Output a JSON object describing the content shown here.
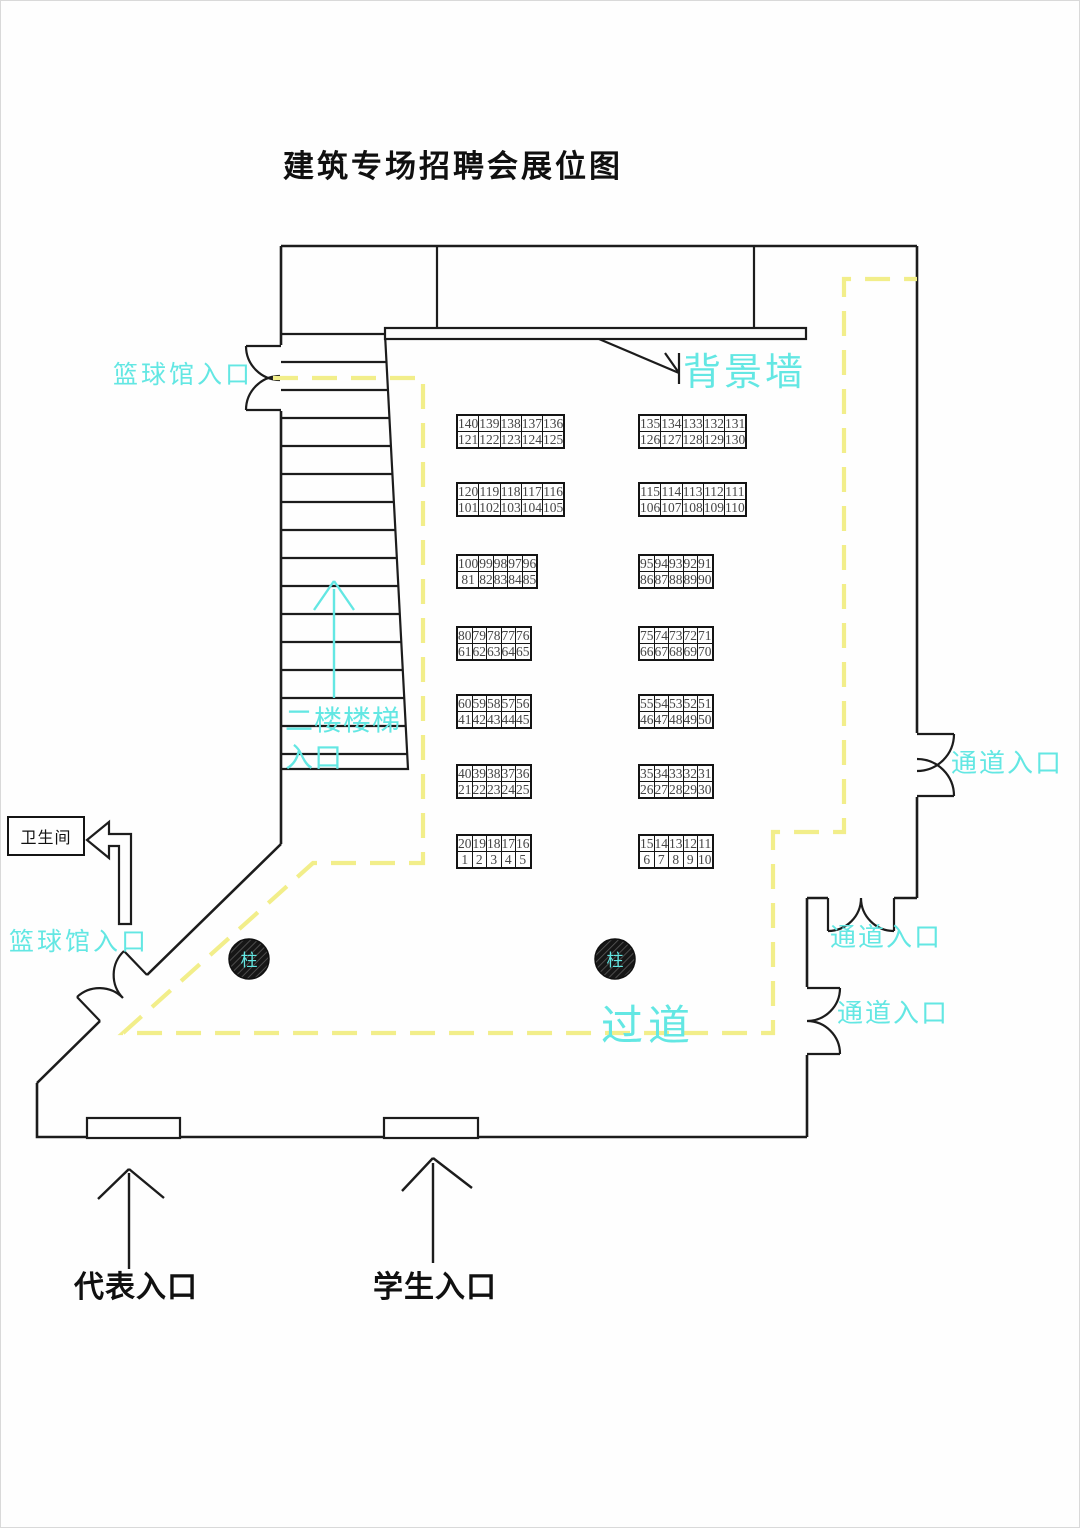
{
  "page": {
    "title": "建筑专场招聘会展位图"
  },
  "colors": {
    "accent_cyan": "#63e7e3",
    "path_yellow": "#f2ee8a",
    "line_ink": "#1c1c1c",
    "booth_number_ink": "#454545"
  },
  "labels": {
    "background_wall": "背景墙",
    "basketball_entrance_top": "篮球馆入口",
    "basketball_entrance_bottom": "篮球馆入口",
    "stairs_line1": "二楼楼梯",
    "stairs_line2": "入口",
    "passage_entrance_1": "通道入口",
    "passage_entrance_2": "通道入口",
    "passage_entrance_3": "通道入口",
    "aisle": "过道",
    "restroom": "卫生间",
    "representative_entrance": "代表入口",
    "student_entrance": "学生入口",
    "column": "柱"
  },
  "booths": {
    "bands": [
      {
        "left": {
          "top": [
            140,
            139,
            138,
            137,
            136
          ],
          "bottom": [
            121,
            122,
            123,
            124,
            125
          ]
        },
        "right": {
          "top": [
            135,
            134,
            133,
            132,
            131
          ],
          "bottom": [
            126,
            127,
            128,
            129,
            130
          ]
        }
      },
      {
        "left": {
          "top": [
            120,
            119,
            118,
            117,
            116
          ],
          "bottom": [
            101,
            102,
            103,
            104,
            105
          ]
        },
        "right": {
          "top": [
            115,
            114,
            113,
            112,
            111
          ],
          "bottom": [
            106,
            107,
            108,
            109,
            110
          ]
        }
      },
      {
        "left": {
          "top": [
            100,
            99,
            98,
            97,
            96
          ],
          "bottom": [
            81,
            82,
            83,
            84,
            85
          ]
        },
        "right": {
          "top": [
            95,
            94,
            93,
            92,
            91
          ],
          "bottom": [
            86,
            87,
            88,
            89,
            90
          ]
        }
      },
      {
        "left": {
          "top": [
            80,
            79,
            78,
            77,
            76
          ],
          "bottom": [
            61,
            62,
            63,
            64,
            65
          ]
        },
        "right": {
          "top": [
            75,
            74,
            73,
            72,
            71
          ],
          "bottom": [
            66,
            67,
            68,
            69,
            70
          ]
        }
      },
      {
        "left": {
          "top": [
            60,
            59,
            58,
            57,
            56
          ],
          "bottom": [
            41,
            42,
            43,
            44,
            45
          ]
        },
        "right": {
          "top": [
            55,
            54,
            53,
            52,
            51
          ],
          "bottom": [
            46,
            47,
            48,
            49,
            50
          ]
        }
      },
      {
        "left": {
          "top": [
            40,
            39,
            38,
            37,
            36
          ],
          "bottom": [
            21,
            22,
            23,
            24,
            25
          ]
        },
        "right": {
          "top": [
            35,
            34,
            33,
            32,
            31
          ],
          "bottom": [
            26,
            27,
            28,
            29,
            30
          ]
        }
      },
      {
        "left": {
          "top": [
            20,
            19,
            18,
            17,
            16
          ],
          "bottom": [
            1,
            2,
            3,
            4,
            5
          ]
        },
        "right": {
          "top": [
            15,
            14,
            13,
            12,
            11
          ],
          "bottom": [
            6,
            7,
            8,
            9,
            10
          ]
        }
      }
    ]
  }
}
